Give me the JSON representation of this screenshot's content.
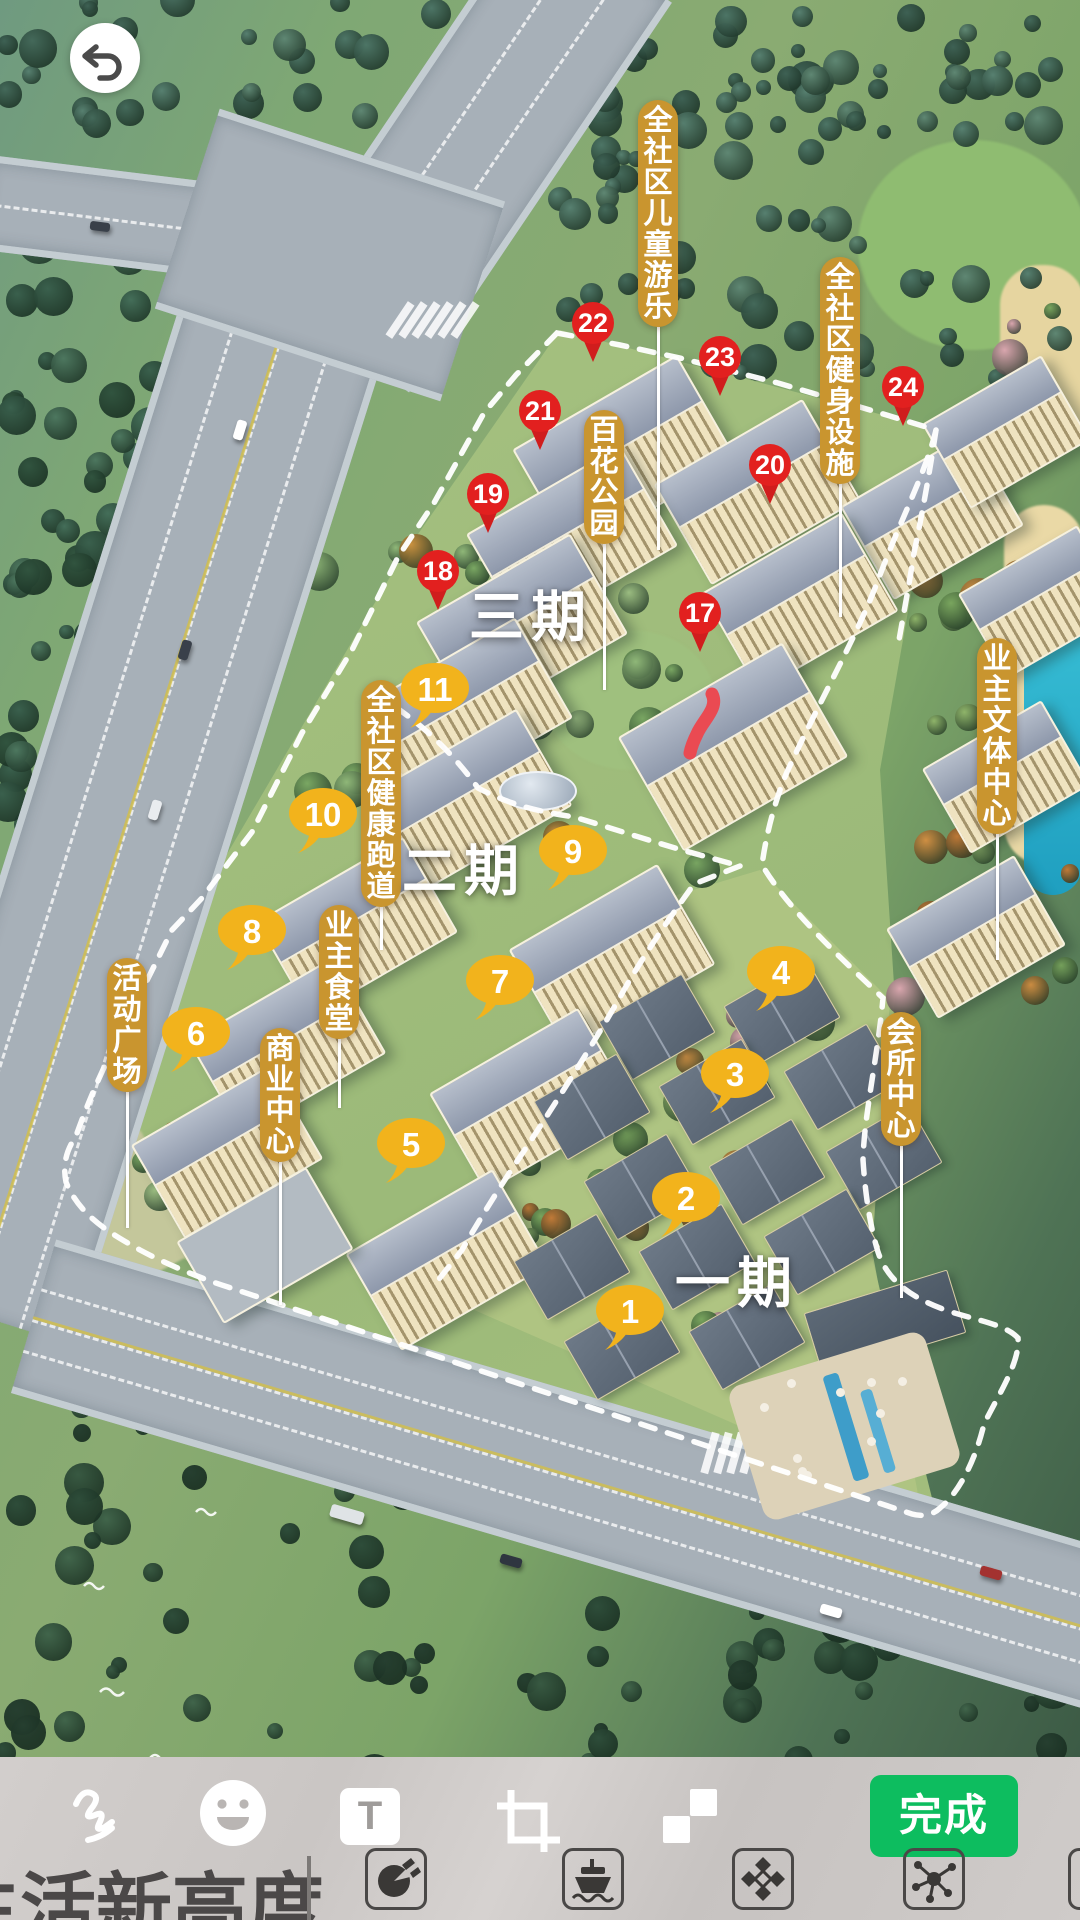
{
  "editor": {
    "back_button": {
      "icon": "undo-arrow-icon"
    },
    "toolbar": {
      "tools": [
        {
          "name": "draw",
          "icon": "pen-squiggle-icon"
        },
        {
          "name": "sticker",
          "icon": "smiley-icon"
        },
        {
          "name": "text",
          "icon": "letter-t-icon",
          "label": "T"
        },
        {
          "name": "crop",
          "icon": "crop-frame-icon"
        },
        {
          "name": "mosaic",
          "icon": "checkerboard-icon"
        }
      ],
      "done_label": "完成"
    },
    "sticker_tray": {
      "watermark_text": "生活新高度",
      "stickers": [
        {
          "name": "palette-icon"
        },
        {
          "name": "ship-icon"
        },
        {
          "name": "diamond-pattern-icon"
        },
        {
          "name": "molecule-icon"
        },
        {
          "name": "partial-sticker-icon"
        }
      ]
    },
    "colors": {
      "done_green": "#0dbd5f",
      "toolbar_bg": "#cac6c4",
      "pin_red": "#e2201f",
      "marker_yellow": "#f2b31c",
      "tag_gold": "#c9952f"
    }
  },
  "map": {
    "phase_labels": [
      {
        "text": "三期",
        "x": 531,
        "y": 612
      },
      {
        "text": "二期",
        "x": 464,
        "y": 866
      },
      {
        "text": "一期",
        "x": 737,
        "y": 1278
      }
    ],
    "red_pins": [
      {
        "num": "17",
        "x": 700,
        "y": 613
      },
      {
        "num": "18",
        "x": 438,
        "y": 571
      },
      {
        "num": "19",
        "x": 488,
        "y": 494
      },
      {
        "num": "20",
        "x": 770,
        "y": 465
      },
      {
        "num": "21",
        "x": 540,
        "y": 411
      },
      {
        "num": "22",
        "x": 593,
        "y": 323
      },
      {
        "num": "23",
        "x": 720,
        "y": 357
      },
      {
        "num": "24",
        "x": 903,
        "y": 387
      }
    ],
    "yellow_markers": [
      {
        "num": "1",
        "x": 630,
        "y": 1310
      },
      {
        "num": "2",
        "x": 686,
        "y": 1197
      },
      {
        "num": "3",
        "x": 735,
        "y": 1073
      },
      {
        "num": "4",
        "x": 781,
        "y": 971
      },
      {
        "num": "5",
        "x": 411,
        "y": 1143
      },
      {
        "num": "6",
        "x": 196,
        "y": 1032
      },
      {
        "num": "7",
        "x": 500,
        "y": 980
      },
      {
        "num": "8",
        "x": 252,
        "y": 930
      },
      {
        "num": "9",
        "x": 573,
        "y": 850
      },
      {
        "num": "10",
        "x": 323,
        "y": 813
      },
      {
        "num": "11",
        "x": 435,
        "y": 688
      }
    ],
    "info_tags": [
      {
        "text": "全社区儿童游乐",
        "x": 658,
        "top": 100,
        "line_to": 550
      },
      {
        "text": "全社区健身设施",
        "x": 840,
        "top": 257,
        "line_to": 617
      },
      {
        "text": "百花公园",
        "x": 604,
        "top": 410,
        "line_to": 690
      },
      {
        "text": "业主文体中心",
        "x": 997,
        "top": 638,
        "line_to": 960
      },
      {
        "text": "全社区健康跑道",
        "x": 381,
        "top": 680,
        "line_to": 950
      },
      {
        "text": "业主食堂",
        "x": 339,
        "top": 905,
        "line_to": 1108
      },
      {
        "text": "活动广场",
        "x": 127,
        "top": 958,
        "line_to": 1228
      },
      {
        "text": "商业中心",
        "x": 280,
        "top": 1028,
        "line_to": 1305
      },
      {
        "text": "会所中心",
        "x": 901,
        "top": 1012,
        "line_to": 1298
      }
    ]
  }
}
